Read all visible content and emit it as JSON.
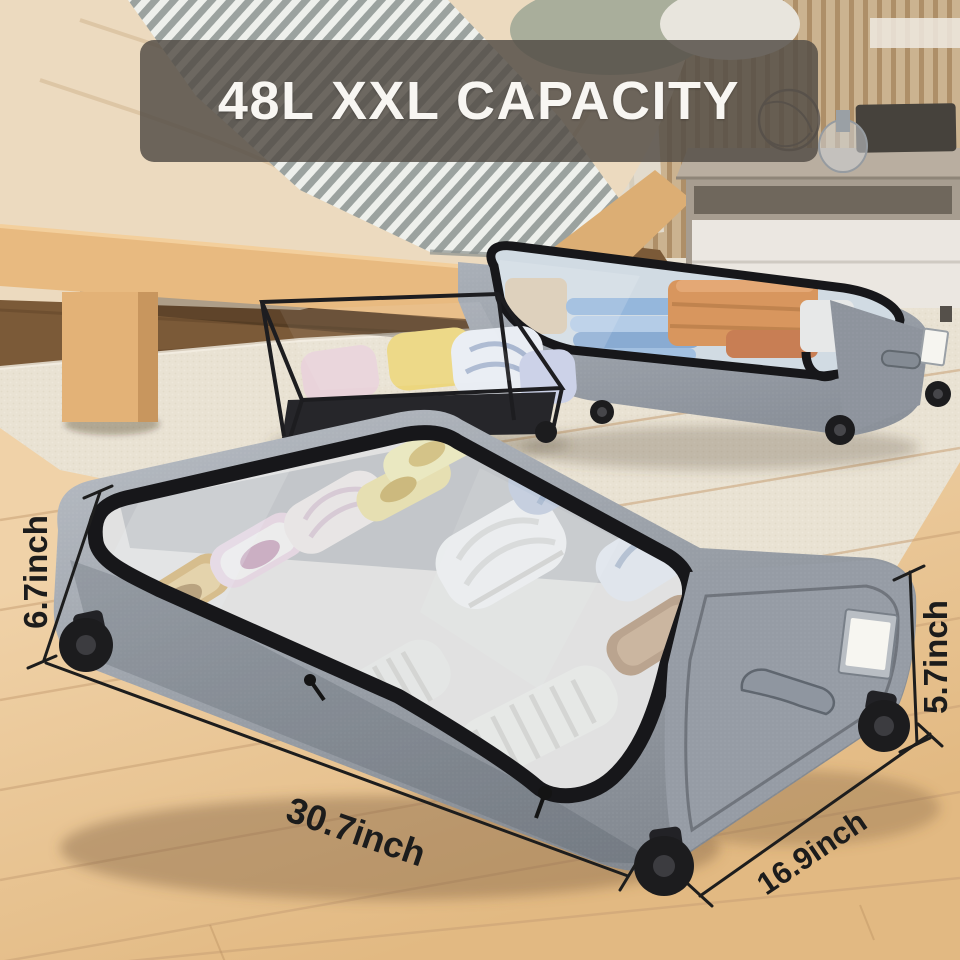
{
  "title": {
    "label": "48L XXL CAPACITY"
  },
  "measurements": {
    "total_height": "6.7inch",
    "side_height": "5.7inch",
    "length": "30.7inch",
    "depth": "16.9inch"
  },
  "colors": {
    "banner_background": "rgba(84,78,70,0.84)",
    "banner_text": "#f8f6f2",
    "annotation_text": "#1c1c1c",
    "annotation_line": "#1d1d1d",
    "box_fabric_gray": "#9ba1a9",
    "box_trim_black": "#17171a",
    "window_glass": "rgba(214,226,236,0.45)",
    "wood_floor": "#ecca9e",
    "area_rug": "#e9e2d3",
    "dark_wood_floor": "#7b5a38",
    "bed_duvet": "#ecdabf",
    "bed_frame_wood": "#e8ba80"
  }
}
